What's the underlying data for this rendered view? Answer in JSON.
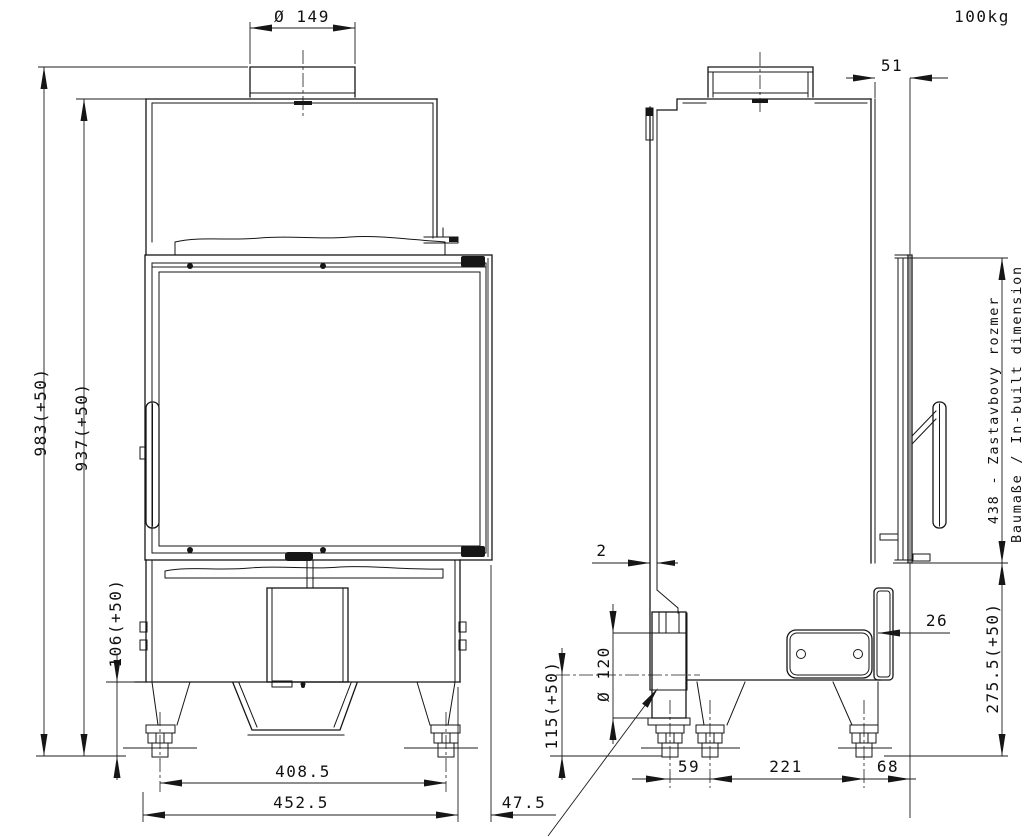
{
  "drawing": {
    "weight": "100kg",
    "front_view": {
      "flue_diameter": "Ø 149",
      "overall_height": "983(+50)",
      "body_height": "937(+50)",
      "plinth_height": "106(+50)",
      "foot_centers_width": "408.5",
      "body_width": "452.5",
      "door_side_overhang": "47.5"
    },
    "side_view": {
      "door_front_depth": "51",
      "rear_wall_gap": "2",
      "air_intake_diameter": "Ø 120",
      "air_intake_axis_height": "115(+50)",
      "rear_panel_thickness": "26",
      "inbuilt_dimension_sk": "438 - Zastavbovy rozmer",
      "inbuilt_dimension_de_en": "Baumaße / In-built dimension",
      "plinth_section_height": "275.5(+50)",
      "foot_spacing_front": "59",
      "foot_spacing_middle": "221",
      "rear_foot_offset": "68"
    }
  }
}
